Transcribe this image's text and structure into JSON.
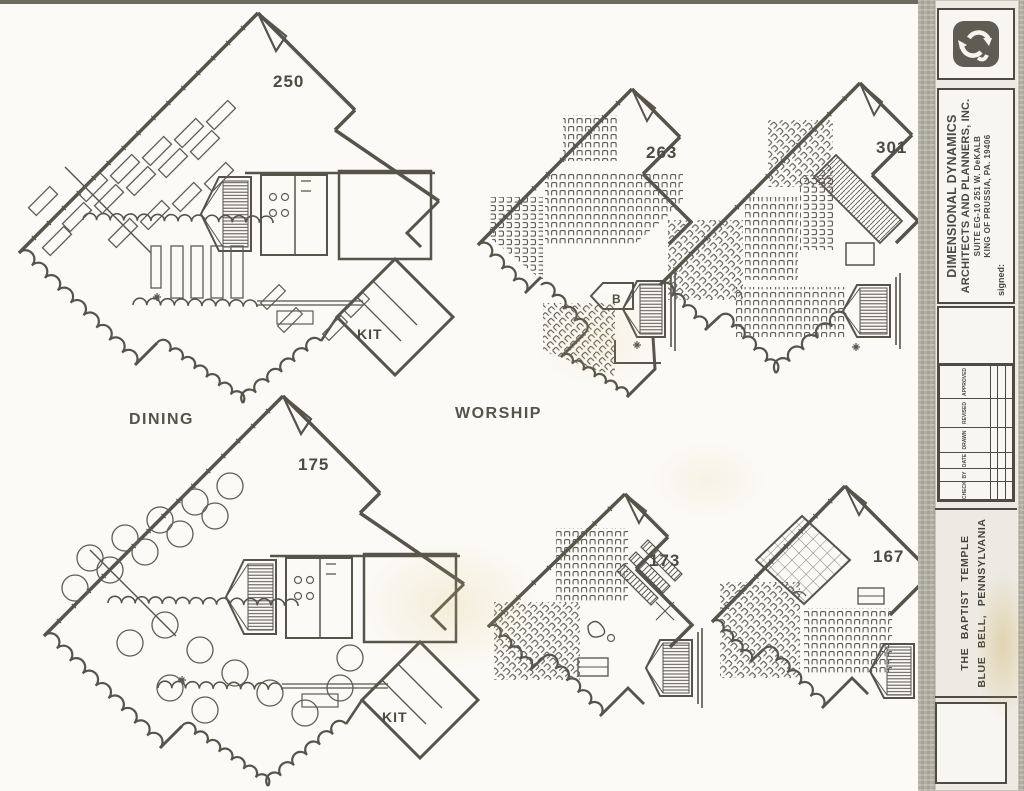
{
  "sheet": {
    "labels": {
      "dining": "DINING",
      "worship": "WORSHIP"
    },
    "plans": {
      "p250": {
        "number": "250",
        "kit": "KIT"
      },
      "p263": {
        "number": "263",
        "balcony": "B"
      },
      "p301": {
        "number": "301"
      },
      "p175": {
        "number": "175",
        "kit": "KIT"
      },
      "p173": {
        "number": "173"
      },
      "p167": {
        "number": "167"
      }
    }
  },
  "title_block": {
    "logo_icon": "recycle-arrows-icon",
    "firm_name_line1": "DIMENSIONAL DYNAMICS",
    "firm_name_line2": "ARCHITECTS AND PLANNERS, INC.",
    "firm_address_line1": "SUITE EG-10   251 W. DeKALB",
    "firm_address_line2": "KING OF PRUSSIA, PA. 19406",
    "signed_label": "signed:",
    "revision_table": {
      "columns": [
        "CHECKED",
        "BY",
        "DATE",
        "DRAWN",
        "REVISED",
        "APPROVED"
      ]
    },
    "project_name_line1": "THE BAPTIST TEMPLE",
    "project_name_line2": "BLUE BELL, PENNSYLVANIA"
  },
  "colors": {
    "paper": "#fbfaf6",
    "ink": "#56534b",
    "sidebar_gray": "#b6b2a8"
  }
}
